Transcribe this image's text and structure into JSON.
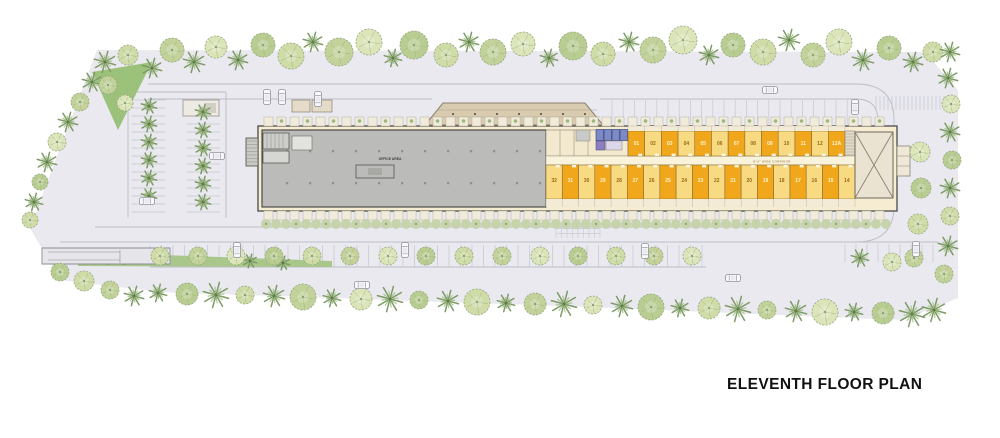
{
  "title": "ELEVENTH FLOOR PLAN",
  "building": {
    "hall_label": "OFFICE AREA",
    "corridor_label": "8'-0\" WIDE CORRIDOR",
    "top_units": [
      "01",
      "02",
      "03",
      "04",
      "05",
      "06",
      "07",
      "08",
      "09",
      "10",
      "11",
      "12",
      "12A"
    ],
    "bottom_units": [
      "32",
      "31",
      "30",
      "29",
      "28",
      "27",
      "26",
      "25",
      "24",
      "23",
      "22",
      "21",
      "20",
      "19",
      "18",
      "17",
      "16",
      "15",
      "14"
    ]
  },
  "colors": {
    "ground": "#E9E9EF",
    "road_line": "#BDBDC7",
    "building_cream": "#F5ECD2",
    "hall_gray": "#BBBBB9",
    "unit_light": "#F7DA81",
    "unit_dark": "#F1A71B",
    "unit_number_on_dark": "#FFF4CE",
    "unit_number_on_light": "#9A6A14",
    "core_blue": "#7D89C6",
    "tree_green": "#A9C183",
    "palm_green": "#7D9B65",
    "title_text": "#111111"
  }
}
